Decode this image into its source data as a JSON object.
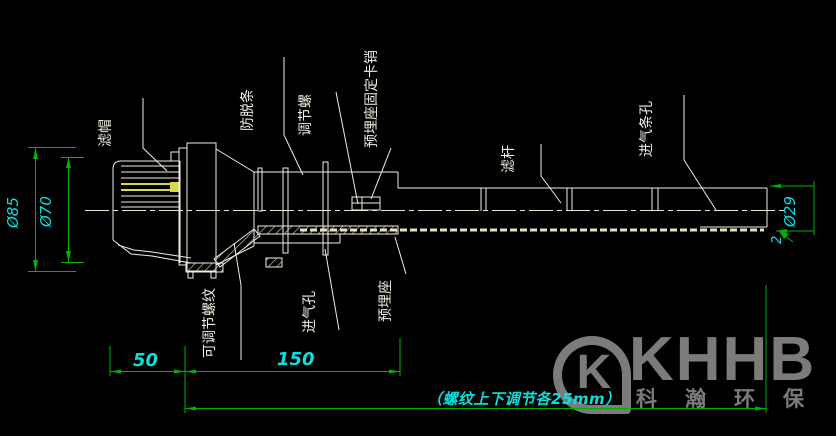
{
  "drawing": {
    "part_labels": {
      "filter_cap": "滤帽",
      "anti_drop_strip": "防脱条",
      "adjust_screw": "调节螺",
      "embed_seat_fixing_pin": "预埋座固定卡销",
      "filter_rod": "滤杆",
      "air_inlet_slot": "进气条孔",
      "adjustable_thread": "可调节螺纹",
      "air_inlet_hole": "进气孔",
      "embedded_seat": "预埋座"
    },
    "dimensions": {
      "dia_85": "Ø85",
      "dia_70": "Ø70",
      "dia_29": "Ø29",
      "thickness_2": "2",
      "len_50": "50",
      "len_150": "150",
      "thread_note": "（螺纹上下调节各25mm）"
    },
    "colors": {
      "background": "#000000",
      "line": "#f0eee2",
      "dimension_line": "#00b200",
      "dimension_text": "#0cdede",
      "highlight_yellow": "#d8d84a",
      "watermark_gray": "#7b7b7b"
    }
  },
  "watermark": {
    "logo_letter": "K",
    "brand": "KHHB",
    "brand_cn": "科瀚环保"
  }
}
